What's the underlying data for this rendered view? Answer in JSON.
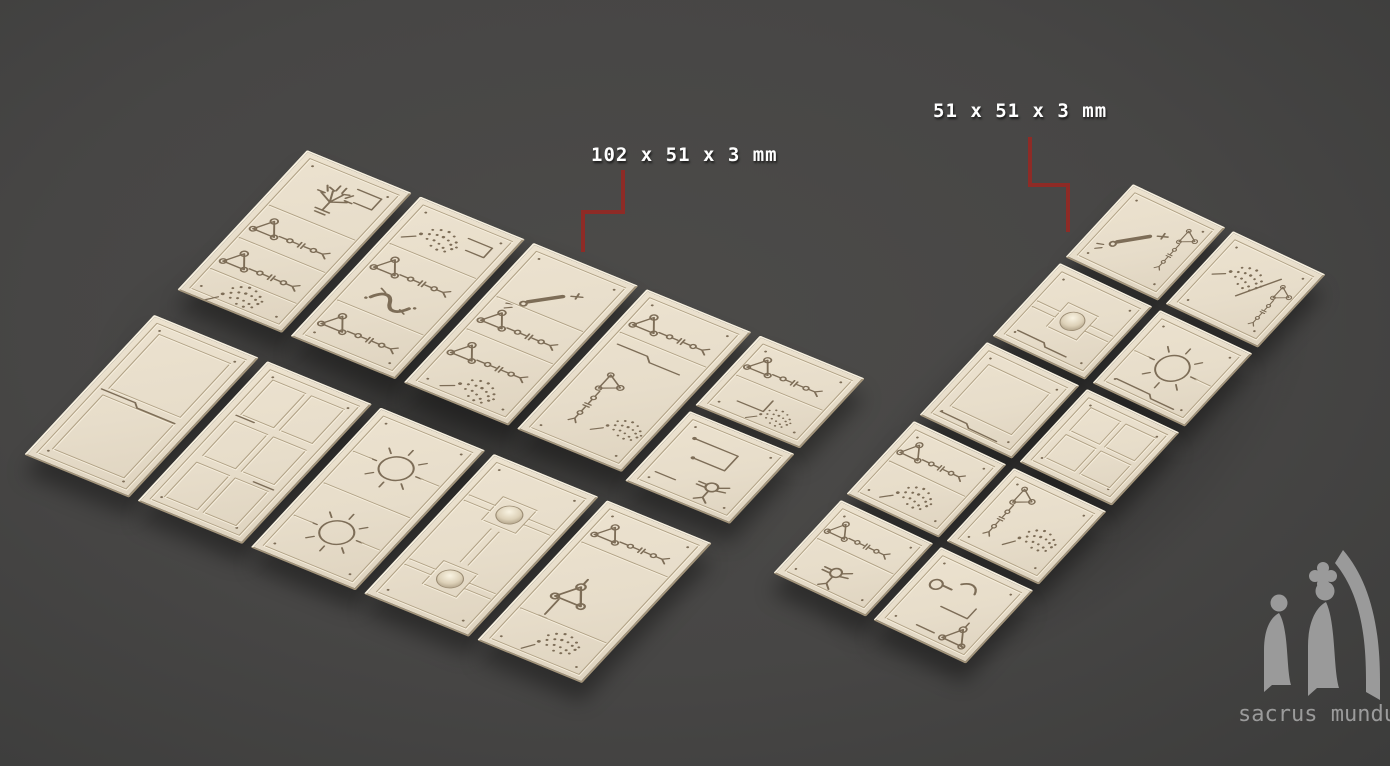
{
  "annotations": {
    "long_tile_label": "102 x 51 x 3 mm",
    "square_tile_label": "51 x 51 x 3 mm",
    "label_color": "#ffffff",
    "leader_color": "#8e2b26",
    "leaders": [
      {
        "target": "long-tile",
        "points": [
          [
            623,
            170
          ],
          [
            623,
            212
          ],
          [
            583,
            212
          ],
          [
            583,
            252
          ]
        ]
      },
      {
        "target": "square-tile",
        "points": [
          [
            1030,
            137
          ],
          [
            1030,
            185
          ],
          [
            1068,
            185
          ],
          [
            1068,
            232
          ]
        ]
      }
    ]
  },
  "logo": {
    "text": "sacrus mundus",
    "color": "#9b9b9b"
  },
  "materials": {
    "background_center": "#4c4b49",
    "background_edge": "#3c3c3b",
    "tile_face": "#e7ddca",
    "tile_edge_light": "#f7f0df",
    "tile_edge_dark": "#a3947a",
    "engraving": "#7d6d57",
    "groove_dark": "#b1a286",
    "groove_light": "#f6eedd"
  },
  "scene": {
    "groups": [
      {
        "name": "left-tile-group",
        "tile_size_mm": "102 x 51 x 3",
        "origin": [
          307,
          150
        ],
        "basis": [
          1.0294,
          0.4216,
          -0.6373,
          0.6863
        ],
        "shade": {
          "x": -40,
          "y": -20,
          "w": 630,
          "h": 500
        },
        "tiles": [
          {
            "x": 0,
            "y": 0,
            "w": 102,
            "h": 204,
            "motif": "sigils-branch"
          },
          {
            "x": 110,
            "y": 0,
            "w": 102,
            "h": 204,
            "motif": "sigils-serpent"
          },
          {
            "x": 220,
            "y": 0,
            "w": 102,
            "h": 204,
            "motif": "sigils-diag-rows"
          },
          {
            "x": 330,
            "y": 0,
            "w": 102,
            "h": 204,
            "motif": "sigils-rows"
          },
          {
            "x": 440,
            "y": 0,
            "w": 102,
            "h": 102,
            "motif": "sigil-sq-rows"
          },
          {
            "x": 440,
            "y": 110,
            "w": 102,
            "h": 102,
            "motif": "sigil-sq-corner"
          },
          {
            "x": 0,
            "y": 240,
            "w": 102,
            "h": 204,
            "motif": "panel-plain"
          },
          {
            "x": 110,
            "y": 240,
            "w": 102,
            "h": 204,
            "motif": "panel-grid"
          },
          {
            "x": 220,
            "y": 240,
            "w": 102,
            "h": 204,
            "motif": "sun-double"
          },
          {
            "x": 330,
            "y": 240,
            "w": 102,
            "h": 204,
            "motif": "dome-double"
          },
          {
            "x": 440,
            "y": 240,
            "w": 102,
            "h": 204,
            "motif": "sigils-dandelion"
          }
        ]
      },
      {
        "name": "right-tile-group",
        "tile_size_mm": "51 x 51 x 3",
        "origin": [
          1133,
          184
        ],
        "basis": [
          0.909,
          0.427,
          -0.664,
          0.718
        ],
        "shade": {
          "x": -30,
          "y": -20,
          "w": 330,
          "h": 620
        },
        "tiles": [
          {
            "x": 0,
            "y": 0,
            "w": 102,
            "h": 102,
            "motif": "sigil-sq-diag"
          },
          {
            "x": 110,
            "y": 0,
            "w": 102,
            "h": 102,
            "motif": "sigil-sq-dandelion"
          },
          {
            "x": 0,
            "y": 110,
            "w": 102,
            "h": 102,
            "motif": "dome-single"
          },
          {
            "x": 110,
            "y": 110,
            "w": 102,
            "h": 102,
            "motif": "sun-single"
          },
          {
            "x": 0,
            "y": 220,
            "w": 102,
            "h": 102,
            "motif": "panel-plain-sq"
          },
          {
            "x": 110,
            "y": 220,
            "w": 102,
            "h": 102,
            "motif": "panel-grid-sq"
          },
          {
            "x": 0,
            "y": 330,
            "w": 102,
            "h": 102,
            "motif": "sigil-sq-dots"
          },
          {
            "x": 110,
            "y": 330,
            "w": 102,
            "h": 102,
            "motif": "sigil-sq-tri"
          },
          {
            "x": 0,
            "y": 440,
            "w": 102,
            "h": 102,
            "motif": "sigil-sq-pk"
          },
          {
            "x": 110,
            "y": 440,
            "w": 102,
            "h": 102,
            "motif": "sigil-sq-step"
          }
        ]
      }
    ]
  }
}
